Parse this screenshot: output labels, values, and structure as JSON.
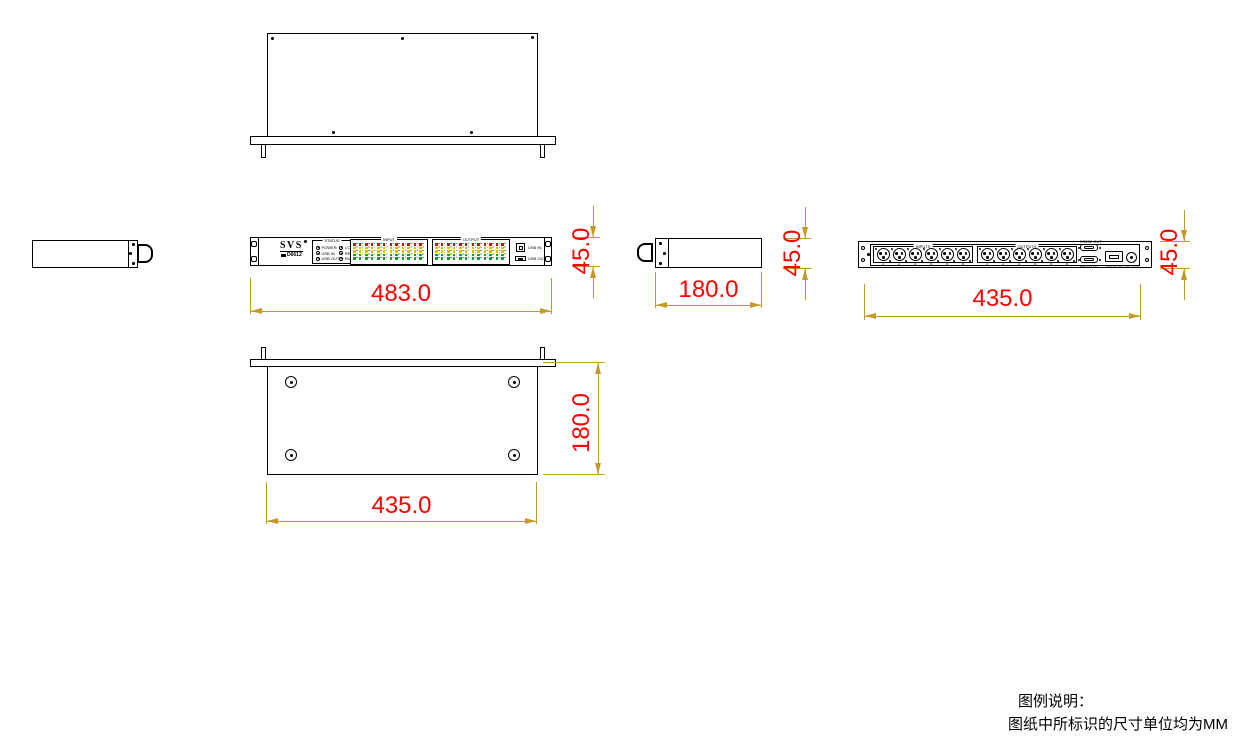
{
  "colors": {
    "dim": "#C49A24",
    "red": "#FF0000",
    "lred": "#CC1100",
    "lyellow": "#E0BC00",
    "lgreen": "#11A02C"
  },
  "dimensions": {
    "front_width": "483.0",
    "front_height": "45.0",
    "side_depth": "180.0",
    "side_height": "45.0",
    "rear_width": "435.0",
    "rear_height": "45.0",
    "bottom_depth": "180.0",
    "bottom_width": "435.0"
  },
  "front_panel": {
    "brand": "SVS",
    "model": "D6612",
    "status": {
      "title": "STATUS",
      "leds": [
        "POWER",
        "LC",
        "USB IN",
        "RESET",
        "USB OUT",
        "RUN"
      ]
    },
    "meters": [
      {
        "title": "INPUT",
        "units": 6
      },
      {
        "title": "OUTPUT",
        "units": 6
      }
    ],
    "led_colors_top_to_bottom": [
      "red",
      "yellow",
      "yellow",
      "green",
      "green"
    ],
    "ports": [
      {
        "label": "USB IN"
      },
      {
        "label": "USB OUT"
      }
    ]
  },
  "rear_panel": {
    "xlr_groups": [
      {
        "title": "INPUTS",
        "count": 6,
        "channels": [
          "1",
          "2",
          "3",
          "4",
          "5",
          "6"
        ]
      },
      {
        "title": "OUTPUTS",
        "count": 6,
        "channels": [
          "1",
          "2",
          "3",
          "4",
          "5",
          "6"
        ]
      }
    ],
    "ports": [
      {
        "label": "RS232 OUT"
      },
      {
        "label": "RS232 IN"
      },
      {
        "label": "OPTICAL"
      },
      {
        "label": "DC 12V"
      }
    ]
  },
  "notes": {
    "legend_title": "图例说明：",
    "unit_note": "图纸中所标识的尺寸单位均为MM"
  }
}
